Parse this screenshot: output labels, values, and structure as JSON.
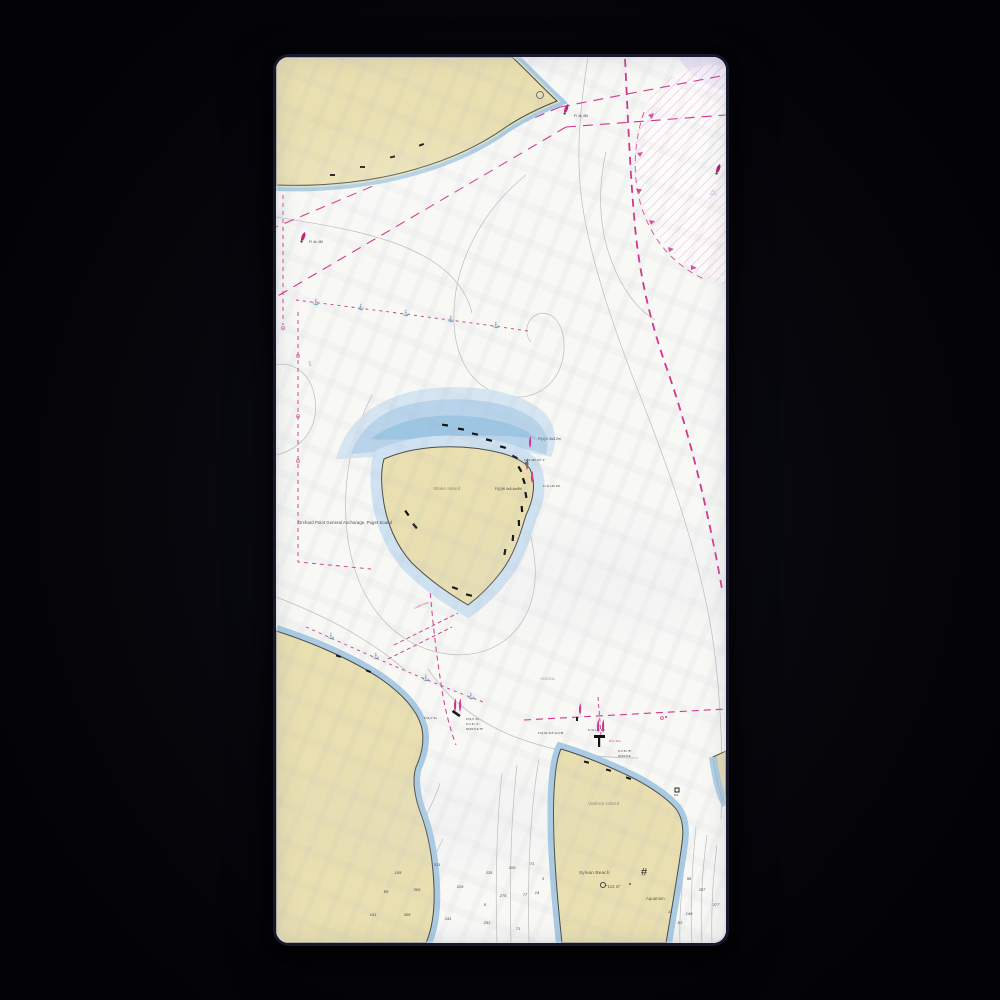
{
  "scene": {
    "background_color": "#040408",
    "product": "beach-towel-nautical-chart-mockup"
  },
  "map": {
    "colors": {
      "paper": "#f8f8f5",
      "land_tan": "#e9dfb0",
      "foreshore_green": "#d9e0c5",
      "shallow_blue": "#a9cbe3",
      "shallow_blue_light": "#cfe2f1",
      "contour_gray": "#b9b9b9",
      "chart_magenta": "#d4338c",
      "lavender": "#e9e2f4"
    },
    "place_labels": [
      {
        "name": "anchorage-label",
        "text": "Orchard Point General Anchorage, Puget Sound",
        "x": 22,
        "y": 464,
        "size": 4.2,
        "color": "#44443e"
      },
      {
        "name": "blake-island-label",
        "text": "Blake Island",
        "x": 158,
        "y": 430,
        "size": 4.6,
        "color": "#8a8a7a"
      },
      {
        "name": "vashon-island-label",
        "text": "Vashon Island",
        "x": 312,
        "y": 746,
        "size": 4.8,
        "color": "#8a8a7a"
      },
      {
        "name": "sylvan-beach-label",
        "text": "Sylvan Beach",
        "x": 303,
        "y": 815,
        "size": 4.8,
        "color": "#55554e"
      },
      {
        "name": "depth-note-label",
        "text": "\"113 m\"",
        "x": 330,
        "y": 828,
        "size": 4.2,
        "color": "#55554e"
      },
      {
        "name": "aquarium-label",
        "text": "Aquarium",
        "x": 370,
        "y": 840,
        "size": 4.2,
        "color": "#55554e"
      },
      {
        "name": "obstruction-note-label",
        "text": "*OOOOL",
        "x": 264,
        "y": 621,
        "size": 3.6,
        "color": "#8c8c8c"
      },
      {
        "name": "contour-depth-label",
        "text": "299",
        "x": 30,
        "y": 305,
        "size": 3.4,
        "color": "#9a9a9a",
        "rot": 78
      }
    ],
    "nav_labels": [
      {
        "name": "light-label",
        "text": "Fl 4s 4M",
        "x": 298,
        "y": 58,
        "size": 3.4,
        "color": "#3a3a3a"
      },
      {
        "name": "light-label",
        "text": "Fl 4s 4M",
        "x": 33,
        "y": 184,
        "size": 3.4,
        "color": "#3a3a3a"
      },
      {
        "name": "light-label",
        "text": "Fl(1)G 4s3.2m",
        "x": 262,
        "y": 381,
        "size": 3.4,
        "color": "#3a3a3a"
      },
      {
        "name": "light-label",
        "text": "Fl 4s 46ft 4M \"1\"",
        "x": 248,
        "y": 403,
        "size": 2.7,
        "color": "#3a3a3a"
      },
      {
        "name": "light-label",
        "text": "Fl(1)W 4s5.4m8M",
        "x": 219,
        "y": 431,
        "size": 3.2,
        "color": "#3a3a3a"
      },
      {
        "name": "light-label",
        "text": "Fl 4s 14ft 4M",
        "x": 267,
        "y": 429,
        "size": 2.7,
        "color": "#3a3a3a"
      },
      {
        "name": "light-label",
        "text": "Fl(1)W 4s5.1m7M",
        "x": 262,
        "y": 675,
        "size": 3.0,
        "color": "#3a3a3a"
      },
      {
        "name": "light-label",
        "text": "Fl 4s 14ft 5M",
        "x": 312,
        "y": 673,
        "size": 2.7,
        "color": "#3a3a3a"
      },
      {
        "name": "private-light-label",
        "text": "Priv 10s",
        "x": 333,
        "y": 683,
        "size": 3.0,
        "color": "#d4338c"
      },
      {
        "name": "light-label",
        "text": "Fl 2.5s \"B\"",
        "x": 342,
        "y": 694,
        "size": 2.7,
        "color": "#3a3a3a"
      },
      {
        "name": "light-label",
        "text": "WHISTLE",
        "x": 342,
        "y": 699,
        "size": 2.7,
        "color": "#3a3a3a"
      },
      {
        "name": "light-label",
        "text": "Fl(1)Y 6s",
        "x": 148,
        "y": 660,
        "size": 3.0,
        "color": "#3a3a3a"
      },
      {
        "name": "light-label",
        "text": "Fl(1)Y 6s",
        "x": 190,
        "y": 661,
        "size": 3.0,
        "color": "#3a3a3a"
      },
      {
        "name": "light-label",
        "text": "Fl 2.5s \"A\"",
        "x": 190,
        "y": 667,
        "size": 2.7,
        "color": "#3a3a3a"
      },
      {
        "name": "light-label",
        "text": "WHISTLE \"B\"",
        "x": 190,
        "y": 672,
        "size": 2.7,
        "color": "#3a3a3a"
      },
      {
        "name": "cable-area-label",
        "text": "Cable Area",
        "x": 138,
        "y": 547,
        "size": 2.8,
        "color": "#d4338c",
        "rot": -22
      },
      {
        "name": "dolphin-label",
        "text": "Dol",
        "x": 398,
        "y": 738,
        "size": 2.6,
        "color": "#3a3a3a"
      }
    ],
    "soundings": [
      {
        "v": "311",
        "x": 161,
        "y": 808
      },
      {
        "v": "155",
        "x": 122,
        "y": 816
      },
      {
        "v": "305",
        "x": 141,
        "y": 833
      },
      {
        "v": "329",
        "x": 184,
        "y": 830
      },
      {
        "v": "335",
        "x": 213,
        "y": 816
      },
      {
        "v": "209",
        "x": 236,
        "y": 811
      },
      {
        "v": "71",
        "x": 256,
        "y": 807
      },
      {
        "v": "89",
        "x": 110,
        "y": 835
      },
      {
        "v": "275",
        "x": 227,
        "y": 839
      },
      {
        "v": "77",
        "x": 249,
        "y": 838
      },
      {
        "v": "14",
        "x": 261,
        "y": 836
      },
      {
        "v": "5",
        "x": 209,
        "y": 848
      },
      {
        "v": "161",
        "x": 97,
        "y": 858
      },
      {
        "v": "305",
        "x": 131,
        "y": 858
      },
      {
        "v": "341",
        "x": 172,
        "y": 862
      },
      {
        "v": "251",
        "x": 211,
        "y": 866
      },
      {
        "v": "71",
        "x": 242,
        "y": 872
      },
      {
        "v": "3",
        "x": 267,
        "y": 822
      },
      {
        "v": "95",
        "x": 413,
        "y": 822
      },
      {
        "v": "257",
        "x": 426,
        "y": 833
      },
      {
        "v": "377",
        "x": 440,
        "y": 848
      },
      {
        "v": "149",
        "x": 413,
        "y": 857
      },
      {
        "v": "83",
        "x": 404,
        "y": 866
      },
      {
        "v": "11",
        "x": 394,
        "y": 855
      }
    ],
    "symbols": [
      {
        "name": "anchor-icon",
        "glyph": "⚓",
        "x": 40,
        "y": 246,
        "size": 6,
        "color": "#d4338c"
      },
      {
        "name": "anchor-icon",
        "glyph": "⚓",
        "x": 85,
        "y": 251,
        "size": 6,
        "color": "#d4338c"
      },
      {
        "name": "anchor-icon",
        "glyph": "⚓",
        "x": 130,
        "y": 257,
        "size": 6,
        "color": "#d4338c"
      },
      {
        "name": "anchor-icon",
        "glyph": "⚓",
        "x": 175,
        "y": 263,
        "size": 6,
        "color": "#d4338c"
      },
      {
        "name": "anchor-icon",
        "glyph": "⚓",
        "x": 220,
        "y": 269,
        "size": 6,
        "color": "#d4338c"
      },
      {
        "name": "anchor-icon",
        "glyph": "⚓",
        "x": 55,
        "y": 580,
        "size": 6,
        "color": "#d4338c"
      },
      {
        "name": "anchor-icon",
        "glyph": "⚓",
        "x": 100,
        "y": 600,
        "size": 6,
        "color": "#d4338c"
      },
      {
        "name": "anchor-icon",
        "glyph": "⚓",
        "x": 150,
        "y": 622,
        "size": 6,
        "color": "#d4338c"
      },
      {
        "name": "anchor-icon",
        "glyph": "⚓",
        "x": 195,
        "y": 640,
        "size": 6,
        "color": "#d4338c"
      },
      {
        "name": "anchorage-boundary-icon",
        "glyph": "⊖",
        "x": 22,
        "y": 300,
        "size": 6,
        "color": "#d4338c"
      },
      {
        "name": "anchorage-boundary-icon",
        "glyph": "⊖",
        "x": 22,
        "y": 360,
        "size": 6,
        "color": "#d4338c"
      },
      {
        "name": "anchorage-boundary-icon",
        "glyph": "⊖",
        "x": 22,
        "y": 405,
        "size": 6,
        "color": "#d4338c"
      },
      {
        "name": "anchorage-boundary-icon",
        "glyph": "⊖",
        "x": 7,
        "y": 272,
        "size": 6,
        "color": "#d4338c"
      },
      {
        "name": "landmark-icon",
        "glyph": "#",
        "x": 368,
        "y": 816,
        "size": 11,
        "color": "#222222"
      },
      {
        "name": "caution-triangle-icon",
        "glyph": "⚠",
        "x": 437,
        "y": 136,
        "size": 8,
        "color": "#b9a6e6"
      }
    ]
  }
}
